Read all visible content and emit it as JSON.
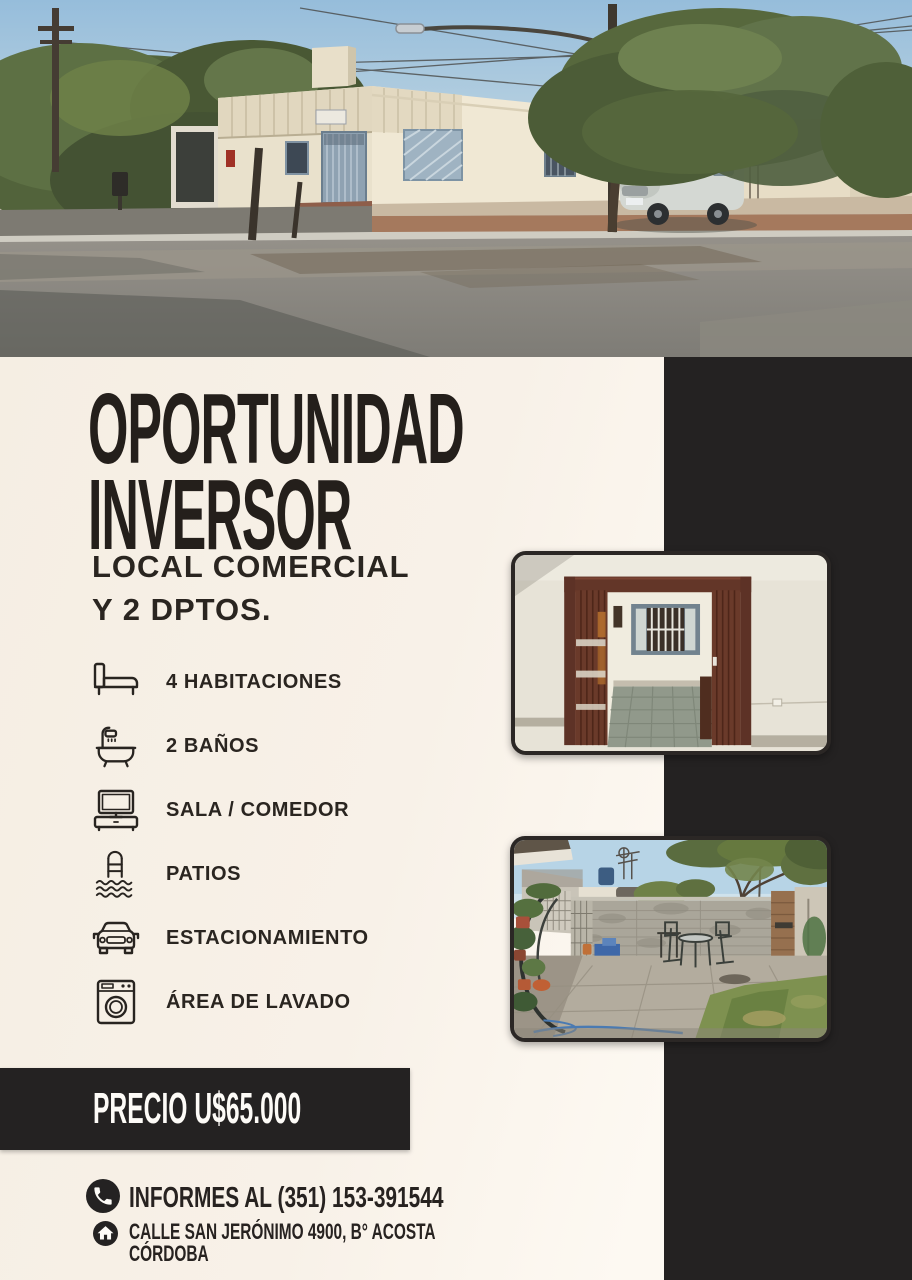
{
  "flyer": {
    "title_line1": "OPORTUNIDAD",
    "title_line2": "INVERSOR",
    "subtitle_line1": "LOCAL COMERCIAL",
    "subtitle_line2": "Y 2 DPTOS.",
    "features": [
      {
        "icon": "bed-icon",
        "label": "4 HABITACIONES"
      },
      {
        "icon": "bathtub-icon",
        "label": "2 BAÑOS"
      },
      {
        "icon": "tv-icon",
        "label": "SALA / COMEDOR"
      },
      {
        "icon": "pool-ladder-icon",
        "label": "PATIOS"
      },
      {
        "icon": "car-icon",
        "label": "ESTACIONAMIENTO"
      },
      {
        "icon": "washing-machine-icon",
        "label": "ÁREA DE LAVADO"
      }
    ],
    "price_label": "PRECIO U$65.000",
    "contact": {
      "phone_icon": "phone-icon",
      "phone_label": "INFORMES AL (351) 153-391544",
      "home_icon": "home-icon",
      "address_line1": "CALLE SAN JERÓNIMO 4900, B° ACOSTA",
      "address_line2": "CÓRDOBA"
    },
    "colors": {
      "background_cream": "#f7f0e7",
      "panel_dark": "#242222",
      "text_dark": "#241f1b",
      "text_light": "#fdfbf7"
    },
    "photos": {
      "hero": "street corner view of the commercial property",
      "interior": "interior room seen through wooden folding doors",
      "patio": "back patio with block wall, table and lawn"
    }
  }
}
